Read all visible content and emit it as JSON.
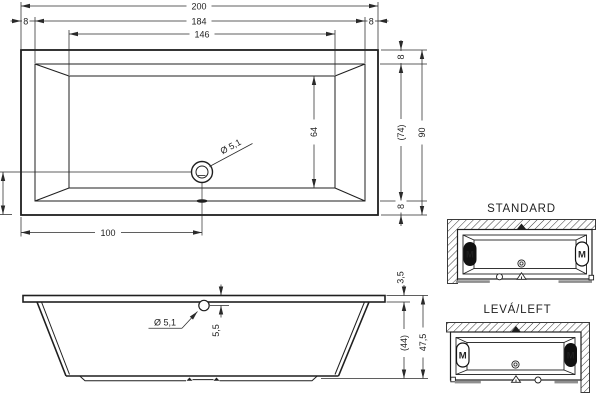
{
  "top_view": {
    "length_total": "200",
    "length_inner_rim": "184",
    "rim_left": "8",
    "rim_right": "8",
    "length_floor": "146",
    "rim_top": "8",
    "width_inner_rim": "(74)",
    "width_total": "90",
    "rim_bottom": "8",
    "width_floor": "64",
    "drain_diameter": "Ø 5,1",
    "drain_from_left_edge": "100"
  },
  "side_view": {
    "drain_diameter": "Ø 5,1",
    "drain_center_from_top": "5,5",
    "rim_thickness": "3,5",
    "body_depth": "(44)",
    "height_total": "47,5"
  },
  "installation_variants": {
    "standard": {
      "title": "STANDARD",
      "motor_label": "M"
    },
    "left": {
      "title": "LEVÁ/LEFT",
      "motor_label": "M"
    }
  },
  "colors": {
    "line": "#1f1f1f",
    "dimension_line": "#2a2a2a",
    "motor_fill": "#111111",
    "skirt_bar_gray": "#8f8f8f",
    "background": "#ffffff"
  }
}
